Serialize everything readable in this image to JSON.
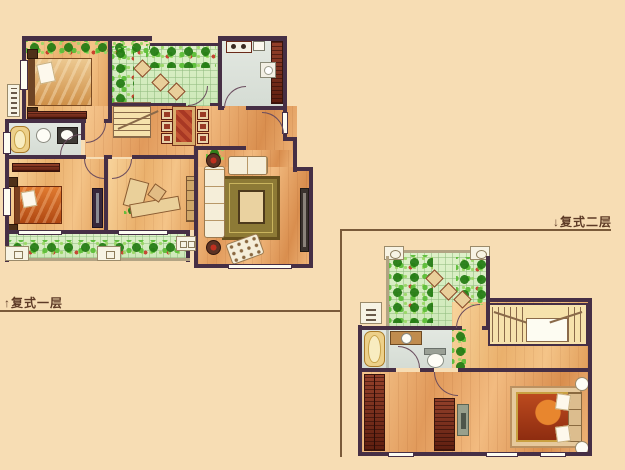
{
  "page": {
    "background_color": "#f7ddb4"
  },
  "palette": {
    "wall": "#462f45",
    "wood_floor": "#e29a5a",
    "garden_green": "#cde8b8",
    "plant_green": "#4aa52e",
    "tile_gray": "#dce2da",
    "cabinet_redwood": "#7a2f1b",
    "bathtub_gold": "#edd089",
    "label_text": "#5d3a26",
    "divider_line": "#7a5a3a"
  },
  "plans": [
    {
      "id": "first-floor",
      "label": "↑复式一层",
      "features": [
        "north-balcony-garden",
        "bedroom-upper",
        "courtyard-garden",
        "kitchen",
        "staircase",
        "dining-table-six-chairs",
        "bathroom-with-tub",
        "bedroom-lower",
        "study-with-desk",
        "living-room-sofa-set",
        "tv-cabinet",
        "south-balcony-garden",
        "entry-door"
      ]
    },
    {
      "id": "second-floor",
      "label": "↓复式二层",
      "features": [
        "roof-terrace-garden",
        "stairwell",
        "bathroom-with-tub",
        "wardrobes",
        "master-bedroom",
        "bedside-rug"
      ]
    }
  ]
}
